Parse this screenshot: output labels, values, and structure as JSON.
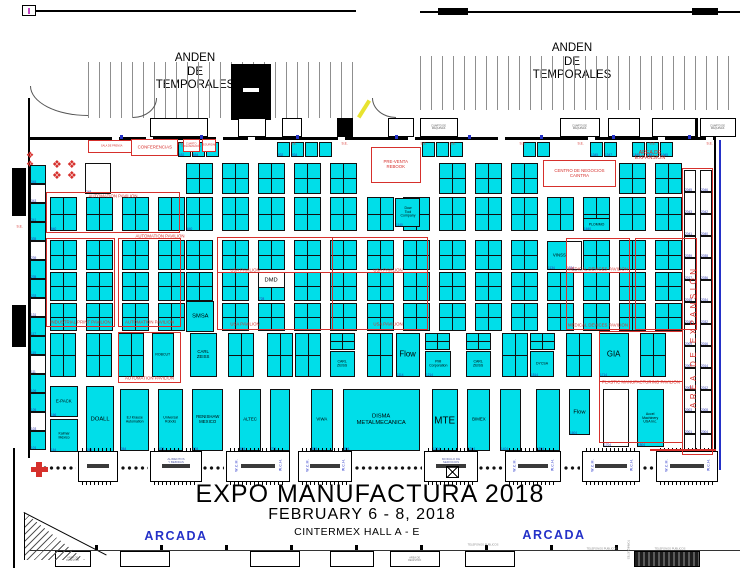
{
  "colors": {
    "cyan": "#00DEE9",
    "red": "#D6302C",
    "blue": "#2431C8",
    "numblue": "#2B34B0",
    "yellow": "#E8E32F"
  },
  "labels": {
    "anden": "ANDEN\nDE\nTEMPORALES",
    "arcada": "ARCADA",
    "area_expansion_top": "AREA DE\nEXPANSIÓN",
    "area_expansion_side": "AREA DE EXPANSIÓN",
    "torniquetes": "TORNIQUETES",
    "tables_large": "❖ ❖\n❖ ❖",
    "tables_small": "❖\n❖"
  },
  "title": {
    "line1": "EXPO MANUFACTURA 2018",
    "line2": "FEBRUARY 6 - 8, 2018",
    "line3": "CINTERMEX HALL A - E"
  },
  "zones": [
    {
      "name": "sala-de-prensa",
      "label": "SALA DE PRENSA",
      "x": 88,
      "y": 140,
      "w": 47,
      "h": 13,
      "size": "s-xxs"
    },
    {
      "name": "conferencias",
      "label": "CONFERENCIAS",
      "x": 131,
      "y": 139,
      "w": 47,
      "h": 17,
      "size": "s-sm"
    },
    {
      "name": "cuarto-organizacion",
      "label": "CUARTO\nORGANIZACIÓN",
      "x": 183,
      "y": 139,
      "w": 17,
      "h": 13,
      "size": "s-xxs"
    },
    {
      "name": "seguridad",
      "label": "SEGURIDAD",
      "x": 202,
      "y": 139,
      "w": 14,
      "h": 13,
      "size": "s-xxs"
    },
    {
      "name": "pre-venta-rebook",
      "label": "PRE-VENTA\nREBOOK",
      "x": 371,
      "y": 147,
      "w": 50,
      "h": 36,
      "size": "s-sm"
    },
    {
      "name": "centro-de-negocios-caintra",
      "label": "CENTRO DE NEGOCIOS\nCAINTRA",
      "x": 543,
      "y": 160,
      "w": 73,
      "h": 27,
      "size": "s-sm"
    }
  ],
  "pavilions": [
    {
      "name": "automation-pavilion-1",
      "label": "AUTOMATION PAVILION",
      "x": 46,
      "y": 192,
      "w": 134,
      "h": 41,
      "pos": "top"
    },
    {
      "name": "industrial-print-pavilion",
      "label": "INDUSTRIAL PRINT PAVILION",
      "x": 46,
      "y": 238,
      "w": 69,
      "h": 89,
      "pos": "bottom"
    },
    {
      "name": "automation-pavilion-2",
      "label": "AUTOMATION PAVILION",
      "x": 118,
      "y": 238,
      "w": 63,
      "h": 89,
      "pos": "bottom"
    },
    {
      "name": "automation-pavilion-3",
      "label": "AUTOMATION PAVILION",
      "x": 118,
      "y": 332,
      "w": 63,
      "h": 51,
      "pos": "bottom"
    },
    {
      "name": "usa-pavilion",
      "label": "USA PAVILION",
      "x": 217,
      "y": 237,
      "w": 211,
      "h": 93,
      "pos": "none"
    },
    {
      "name": "medical-devices-pavilion",
      "label": "MEDICAL DEVICES PAVILION",
      "x": 566,
      "y": 238,
      "w": 64,
      "h": 92,
      "pos": "bottom"
    },
    {
      "name": "pavilion-right",
      "label": "",
      "x": 635,
      "y": 238,
      "w": 62,
      "h": 92,
      "pos": "none"
    },
    {
      "name": "plastic-manufacturing-pavilion",
      "label": "PLASTIC MANUFACTURING PAVILION",
      "x": 599,
      "y": 331,
      "w": 84,
      "h": 112,
      "pos": "mid"
    },
    {
      "name": "area-expansion-strip",
      "label": "",
      "x": 682,
      "y": 168,
      "w": 31,
      "h": 287,
      "pos": "none"
    }
  ],
  "floating_labels": [
    {
      "text": "AUTOMATION PAVILION",
      "x": 160,
      "y": 233
    },
    {
      "text": "MEDICAL DEVICES PAVILION",
      "x": 598,
      "y": 266
    },
    {
      "text": "USA PAVILION",
      "x": 245,
      "y": 267
    },
    {
      "text": "USA PAVILION",
      "x": 388,
      "y": 267
    },
    {
      "text": "USA PAVILION",
      "x": 245,
      "y": 321
    },
    {
      "text": "USA PAVILION",
      "x": 388,
      "y": 321
    }
  ],
  "red_lines": [
    {
      "x": 217,
      "y": 272,
      "w": 211,
      "h": 1
    },
    {
      "x": 566,
      "y": 272,
      "w": 64,
      "h": 1
    },
    {
      "x": 599,
      "y": 381,
      "w": 84,
      "h": 1
    },
    {
      "x": 332,
      "y": 237,
      "w": 1,
      "h": 93
    },
    {
      "x": 650,
      "y": 449,
      "w": 66,
      "h": 2
    }
  ],
  "booth_rows": [
    {
      "y": 142,
      "h": 15,
      "w": 13,
      "cross": false,
      "xs": [
        178,
        192,
        206,
        277,
        291,
        305,
        319,
        422,
        436,
        450,
        523,
        537,
        590,
        604,
        632,
        646,
        660
      ],
      "nums": [
        "652",
        "654",
        "",
        "932",
        "934",
        "",
        "",
        "",
        "",
        "",
        "",
        "",
        "1345",
        "1347",
        "1845",
        "1847",
        "1945"
      ]
    },
    {
      "y": 163,
      "h": 31,
      "w": 27,
      "cross": true,
      "xs": [
        186,
        222,
        258,
        294,
        330,
        439,
        475,
        511,
        619,
        655
      ]
    },
    {
      "y": 197,
      "h": 34,
      "w": 27,
      "cross": true,
      "xs": [
        50,
        86,
        122,
        158,
        186,
        222,
        258,
        294,
        330,
        367,
        403,
        439,
        475,
        511,
        547,
        583,
        619,
        655
      ],
      "nums": [
        "540",
        "",
        "",
        "",
        "640",
        "",
        "",
        "",
        "",
        "",
        "",
        "",
        "",
        "",
        "",
        "",
        "",
        ""
      ]
    },
    {
      "y": 240,
      "h": 30,
      "w": 27,
      "cross": true,
      "xs": [
        50,
        86,
        122,
        158,
        186,
        222,
        258,
        294,
        330,
        367,
        403,
        439,
        475,
        511,
        583,
        619,
        655
      ]
    },
    {
      "y": 272,
      "h": 29,
      "w": 27,
      "cross": true,
      "xs": [
        50,
        86,
        122,
        158,
        186,
        222,
        258,
        294,
        330,
        367,
        403,
        439,
        475,
        511,
        547,
        583,
        619,
        655
      ],
      "nums": [
        "",
        "",
        "",
        "",
        "",
        "",
        "728",
        "",
        "",
        "",
        "",
        "",
        "",
        "",
        "",
        "",
        "",
        ""
      ]
    },
    {
      "y": 303,
      "h": 28,
      "w": 27,
      "cross": true,
      "xs": [
        50,
        86,
        122,
        158,
        222,
        258,
        294,
        330,
        367,
        403,
        439,
        475,
        511,
        547,
        583,
        619,
        655
      ]
    },
    {
      "y": 333,
      "h": 44,
      "w": 26,
      "cross": true,
      "xs": [
        50,
        86,
        118,
        228,
        267,
        295,
        367,
        502,
        566,
        640
      ]
    },
    {
      "y": 333,
      "h": 17,
      "w": 25,
      "cross": true,
      "xs": [
        330,
        425,
        466,
        530
      ]
    }
  ],
  "named_booths": [
    {
      "label": "",
      "number": "248",
      "x": 85,
      "y": 163,
      "w": 26,
      "h": 31,
      "fill": "white",
      "size": "s-sm"
    },
    {
      "label": "Dow\nTool\nCompany",
      "number": "1140",
      "x": 395,
      "y": 198,
      "w": 25,
      "h": 29,
      "fill": "cyan",
      "size": "s-xs"
    },
    {
      "label": "PLOMMO",
      "number": "1640",
      "x": 583,
      "y": 218,
      "w": 27,
      "h": 13,
      "fill": "cyan",
      "size": "s-xs"
    },
    {
      "label": "VINSSA",
      "number": "1134",
      "x": 547,
      "y": 241,
      "w": 28,
      "h": 29,
      "fill": "cyan",
      "size": "s-sm"
    },
    {
      "label": "",
      "number": "1534",
      "x": 566,
      "y": 241,
      "w": 16,
      "h": 29,
      "fill": "white",
      "size": "s-sm"
    },
    {
      "label": "DMD",
      "number": "",
      "x": 258,
      "y": 272,
      "w": 27,
      "h": 16,
      "fill": "white",
      "size": "s-md"
    },
    {
      "label": "SMSA",
      "number": "",
      "x": 186,
      "y": 301,
      "w": 28,
      "h": 31,
      "fill": "cyan",
      "size": "s-md"
    },
    {
      "label": "ROBCUT",
      "number": "",
      "x": 152,
      "y": 333,
      "w": 22,
      "h": 44,
      "fill": "cyan",
      "size": "s-xs"
    },
    {
      "label": "CARL\nZEISS",
      "number": "",
      "x": 190,
      "y": 333,
      "w": 27,
      "h": 44,
      "fill": "cyan",
      "size": "s-sm"
    },
    {
      "label": "CARL\nZEISS",
      "number": "",
      "x": 330,
      "y": 351,
      "w": 25,
      "h": 26,
      "fill": "cyan",
      "size": "s-xs"
    },
    {
      "label": "Flow",
      "number": "1114",
      "x": 396,
      "y": 333,
      "w": 24,
      "h": 44,
      "fill": "cyan",
      "size": "s-lg"
    },
    {
      "label": "PMI\nCorporation",
      "number": "1214",
      "x": 425,
      "y": 351,
      "w": 26,
      "h": 26,
      "fill": "cyan",
      "size": "s-xs"
    },
    {
      "label": "CARL\nZEISS",
      "number": "",
      "x": 466,
      "y": 351,
      "w": 25,
      "h": 26,
      "fill": "cyan",
      "size": "s-xs"
    },
    {
      "label": "DYCSA",
      "number": "1514",
      "x": 530,
      "y": 351,
      "w": 24,
      "h": 26,
      "fill": "cyan",
      "size": "s-xs"
    },
    {
      "label": "GIA",
      "number": "1714",
      "x": 599,
      "y": 333,
      "w": 30,
      "h": 44,
      "fill": "cyan",
      "size": "s-lg"
    },
    {
      "label": "E-PACK",
      "number": "166",
      "x": 50,
      "y": 386,
      "w": 28,
      "h": 31,
      "fill": "cyan",
      "size": "s-sm"
    },
    {
      "label": "Kalmar\nMéxico",
      "number": "164",
      "x": 50,
      "y": 419,
      "w": 28,
      "h": 33,
      "fill": "cyan",
      "size": "s-xs"
    },
    {
      "label": "DOALL",
      "number": "264",
      "x": 86,
      "y": 386,
      "w": 28,
      "h": 66,
      "fill": "cyan",
      "size": "s-md"
    },
    {
      "label": "EJ Krause\nAutomation",
      "number": "364",
      "x": 120,
      "y": 389,
      "w": 29,
      "h": 62,
      "fill": "cyan",
      "size": "s-xs"
    },
    {
      "label": "Universal\nRobots",
      "number": "404",
      "x": 158,
      "y": 389,
      "w": 25,
      "h": 62,
      "fill": "cyan",
      "size": "s-xs"
    },
    {
      "label": "RENISHAW\nMEXICO",
      "number": "504",
      "x": 192,
      "y": 389,
      "w": 31,
      "h": 62,
      "fill": "cyan",
      "size": "s-sm"
    },
    {
      "label": "ALTEC",
      "number": "604",
      "x": 239,
      "y": 389,
      "w": 22,
      "h": 62,
      "fill": "cyan",
      "size": "s-sm"
    },
    {
      "label": "",
      "number": "704",
      "x": 270,
      "y": 389,
      "w": 20,
      "h": 62,
      "fill": "cyan",
      "size": "s-sm"
    },
    {
      "label": "VIWA",
      "number": "804",
      "x": 311,
      "y": 389,
      "w": 22,
      "h": 62,
      "fill": "cyan",
      "size": "s-sm"
    },
    {
      "label": "DISMA\nMETALMECANICA",
      "number": "904",
      "x": 343,
      "y": 389,
      "w": 77,
      "h": 62,
      "fill": "cyan",
      "size": "s-md"
    },
    {
      "label": "MTE",
      "number": "1204",
      "x": 432,
      "y": 389,
      "w": 26,
      "h": 62,
      "fill": "cyan",
      "size": "s-xl"
    },
    {
      "label": "BIMEX",
      "number": "1304",
      "x": 467,
      "y": 389,
      "w": 23,
      "h": 62,
      "fill": "cyan",
      "size": "s-sm"
    },
    {
      "label": "",
      "number": "1404",
      "x": 500,
      "y": 389,
      "w": 21,
      "h": 62,
      "fill": "cyan",
      "size": "s-sm"
    },
    {
      "label": "",
      "number": "1504",
      "x": 536,
      "y": 389,
      "w": 24,
      "h": 62,
      "fill": "cyan",
      "size": "s-sm"
    },
    {
      "label": "Flow",
      "number": "1604",
      "x": 569,
      "y": 389,
      "w": 21,
      "h": 46,
      "fill": "cyan",
      "size": "s-md"
    },
    {
      "label": "",
      "number": "1704",
      "x": 603,
      "y": 389,
      "w": 26,
      "h": 58,
      "fill": "white",
      "size": "s-sm"
    },
    {
      "label": "Accel\nMachinery\nUSA Inc.",
      "number": "1804",
      "x": 637,
      "y": 389,
      "w": 27,
      "h": 58,
      "fill": "cyan",
      "size": "s-xs"
    }
  ],
  "left_column": {
    "x": 30,
    "w": 16,
    "y0": 165,
    "cell_h": 19,
    "nums": [
      "345",
      "343",
      "341",
      "335",
      "239",
      "235",
      "233",
      "131",
      "117",
      "115",
      "111",
      "109",
      "105",
      "103",
      "101"
    ]
  },
  "expansion_columns": {
    "y0": 170,
    "cell_h": 22,
    "cols": [
      {
        "x": 684,
        "w": 12,
        "nums": [
          "2045",
          "2043",
          "2041",
          "2039",
          "2017",
          "2015",
          "2013",
          "2009",
          "2007",
          "2005",
          "2003",
          "2001",
          ""
        ]
      },
      {
        "x": 700,
        "w": 12,
        "nums": [
          "2046",
          "2042",
          "2040",
          "2038",
          "2036",
          "2034",
          "2032",
          "2016",
          "2014",
          "2012",
          "2008",
          "2004",
          "2002"
        ]
      }
    ]
  },
  "wall_rooms": [
    {
      "x": 150,
      "w": 58,
      "label": ""
    },
    {
      "x": 238,
      "w": 28,
      "label": ""
    },
    {
      "x": 282,
      "w": 20,
      "label": ""
    },
    {
      "x": 388,
      "w": 26,
      "label": ""
    },
    {
      "x": 420,
      "w": 38,
      "label": "CUARTO DE\nMÁQUINAS"
    },
    {
      "x": 560,
      "w": 40,
      "label": "CUARTO DE\nMÁQUINAS"
    },
    {
      "x": 608,
      "w": 32,
      "label": ""
    },
    {
      "x": 652,
      "w": 44,
      "label": ""
    },
    {
      "x": 700,
      "w": 36,
      "label": "CUARTO DE\nMÁQUINAS"
    }
  ],
  "se_text": "S.E.",
  "se_marks": [
    {
      "x": 175,
      "y": 141
    },
    {
      "x": 288,
      "y": 141
    },
    {
      "x": 339,
      "y": 141
    },
    {
      "x": 418,
      "y": 141
    },
    {
      "x": 447,
      "y": 141
    },
    {
      "x": 517,
      "y": 141
    },
    {
      "x": 575,
      "y": 141
    },
    {
      "x": 647,
      "y": 141
    },
    {
      "x": 704,
      "y": 141
    },
    {
      "x": 14,
      "y": 224
    }
  ],
  "wall_blue_ticks": [
    120,
    200,
    296,
    395,
    468,
    540,
    612,
    688
  ],
  "wall_gaps": [
    112,
    146,
    216,
    248,
    338,
    408,
    498,
    588,
    658,
    706
  ],
  "modules": {
    "y": 451,
    "h": 31,
    "items": [
      {
        "x": 78,
        "w": 40,
        "label": "",
        "wc": false
      },
      {
        "x": 150,
        "w": 52,
        "label": "ALIMENTOS\nY BEBIDAS",
        "wc": false
      },
      {
        "x": 226,
        "w": 64,
        "label": "",
        "wc": true
      },
      {
        "x": 298,
        "w": 54,
        "label": "",
        "wc": true
      },
      {
        "x": 424,
        "w": 54,
        "label": "MODULO DE\nSERVICIOS",
        "wc": false
      },
      {
        "x": 505,
        "w": 56,
        "label": "",
        "wc": true
      },
      {
        "x": 582,
        "w": 58,
        "label": "",
        "wc": true
      },
      {
        "x": 656,
        "w": 62,
        "label": "",
        "wc": true
      }
    ],
    "wch": "W.C.H.",
    "wcm": "W.C.M."
  },
  "chains": [
    {
      "x": 42,
      "w": 34
    },
    {
      "x": 120,
      "w": 28
    },
    {
      "x": 202,
      "w": 22
    },
    {
      "x": 354,
      "w": 68
    },
    {
      "x": 478,
      "w": 25
    },
    {
      "x": 563,
      "w": 17
    },
    {
      "x": 642,
      "w": 12
    }
  ],
  "bottom_boxes": [
    {
      "x": 55,
      "w": 36,
      "label": "AREA DE\nREGISTRO"
    },
    {
      "x": 120,
      "w": 50,
      "label": ""
    },
    {
      "x": 250,
      "w": 50,
      "label": ""
    },
    {
      "x": 330,
      "w": 44,
      "label": ""
    },
    {
      "x": 390,
      "w": 50,
      "label": "AREA DE\nREGISTRO"
    },
    {
      "x": 465,
      "w": 50,
      "label": ""
    }
  ],
  "bottom_ticks": [
    95,
    160,
    225,
    290,
    355,
    420,
    485,
    550,
    615
  ],
  "tele_label": "TELEFONOS PUBLICOS",
  "tele_marks": [
    {
      "x": 483,
      "y": 542
    },
    {
      "x": 602,
      "y": 546
    },
    {
      "x": 670,
      "y": 546
    }
  ]
}
